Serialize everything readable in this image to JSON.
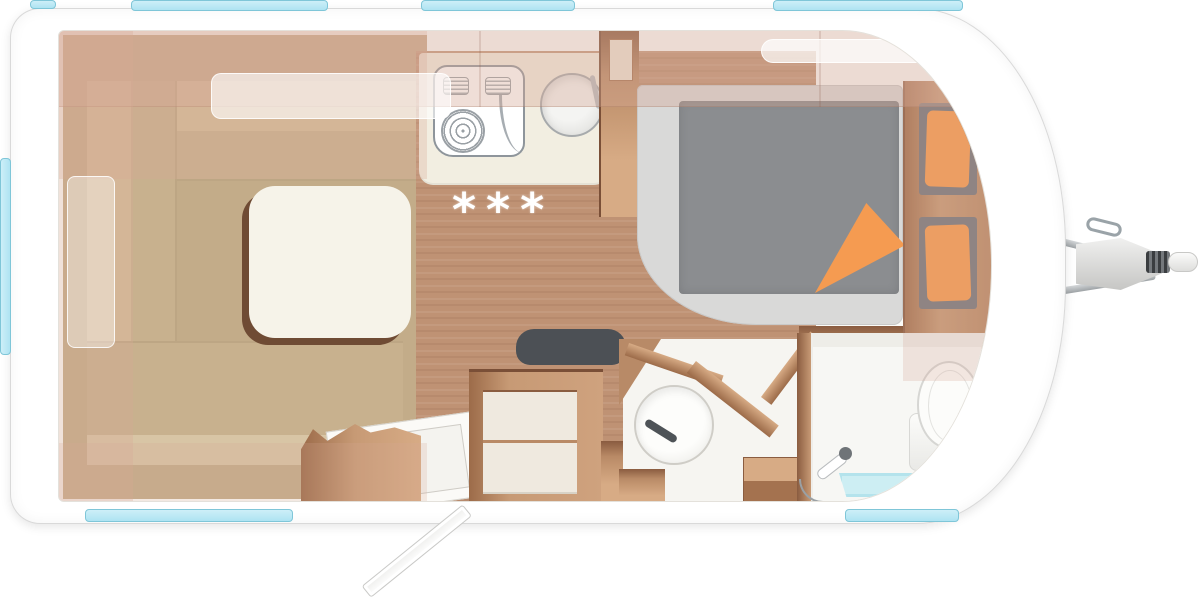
{
  "floorplan": {
    "stars": "***",
    "rooms": [
      {
        "name": "lounge-dinette"
      },
      {
        "name": "kitchen"
      },
      {
        "name": "bedroom"
      },
      {
        "name": "washroom"
      },
      {
        "name": "shower-toilet-room"
      },
      {
        "name": "entrance"
      }
    ],
    "features": [
      "u-shape-seating",
      "dinette-table",
      "kitchen-hob",
      "kitchen-sink",
      "divider-cabinet",
      "double-bed",
      "duvet",
      "folded-blanket-corner",
      "wardrobe-with-pillows",
      "bench-seat",
      "washbasin",
      "cassette-toilet",
      "shower-tray",
      "hand-shower",
      "entry-door-open",
      "tow-hitch",
      "roof-hatches",
      "side-windows"
    ],
    "colors": {
      "window": "#aee3f2",
      "window_border": "#7fc6d8",
      "shell_line": "#d9d9d9",
      "wood_floor": "#bf9274",
      "wood_dark": "#8a5c40",
      "wood_light": "#d7ab85",
      "lounge_floor": "#c3ac89",
      "cushion": "#c8b18e",
      "cushion_back": "#d3bc99",
      "cushion_light": "#d8c5a5",
      "table": "#f6f3e9",
      "table_edge": "#6f4b34",
      "counter": "#f2eee1",
      "bed_base": "#d9d9d8",
      "duvet": "#8b8d90",
      "orange": "#f59b51",
      "niche": "#77797c",
      "seat_dark": "#4c5055",
      "bath_floor": "#f6f5f1",
      "shower_tray": "#cdeef3",
      "steel": "#9ea3a6",
      "overlay": "rgba(214,168,150,0.38)"
    }
  }
}
